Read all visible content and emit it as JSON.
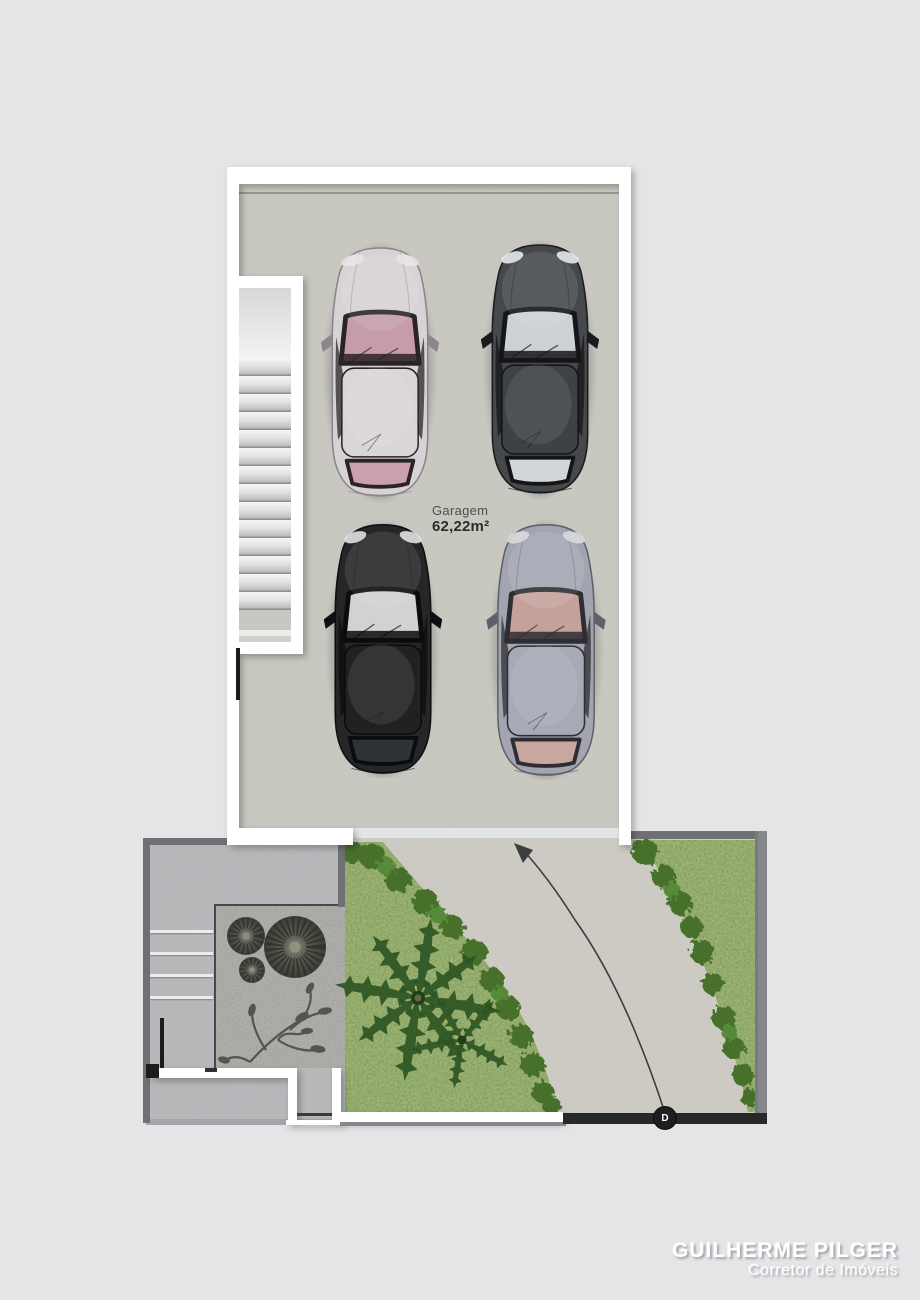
{
  "labels": {
    "garage_name": "Garagem",
    "garage_area": "62,22m²"
  },
  "watermark": {
    "name": "GUILHERME PILGER",
    "role": "Corretor de Imóveis"
  },
  "gate_marker": {
    "label": "D"
  },
  "colors": {
    "page_bg": "#e4e5e7",
    "garage_floor": "#c8c7c0",
    "garage_wall": "#ffffff",
    "boundary_wall": "#6e7073",
    "boundary_wall_light": "#85878a",
    "patio": "#b4b5b8",
    "gravel": "#9d9d9a",
    "grass": "#7c9750",
    "bush": "#46702c",
    "driveway": "#cdcac3",
    "gate_line": "#27282a",
    "path_line": "#3e3e3e",
    "stub_black": "#1c1c1c"
  },
  "garage": {
    "cars": [
      {
        "name": "silver sedan",
        "position": "front-left",
        "colors": {
          "body": "#d7d2d5",
          "edge": "#8a8589",
          "roof": "#dad5d8",
          "interior": "#c59ca7",
          "frame": "#2a2427",
          "rear": "#c9a0ab",
          "light": "#e9e5e7"
        }
      },
      {
        "name": "dark sports coupe",
        "position": "front-right",
        "colors": {
          "body": "#45484c",
          "edge": "#1a1b1d",
          "roof": "#3e4145",
          "interior": "#ccd1d5",
          "frame": "#141517",
          "rear": "#d3d6d8",
          "light": "#e6e9eb"
        }
      },
      {
        "name": "black hatchback",
        "position": "rear-left",
        "colors": {
          "body": "#242628",
          "edge": "#0e0f10",
          "roof": "#1f2123",
          "interior": "#d0d2d3",
          "frame": "#0b0c0d",
          "rear": "#303336",
          "light": "#dfe1e2"
        }
      },
      {
        "name": "gray sedan",
        "position": "rear-right",
        "colors": {
          "body": "#a2a5b0",
          "edge": "#5f616a",
          "roof": "#a7aab5",
          "interior": "#c4a29b",
          "frame": "#2e2d33",
          "rear": "#c8a79e",
          "light": "#d9dade"
        }
      }
    ]
  }
}
